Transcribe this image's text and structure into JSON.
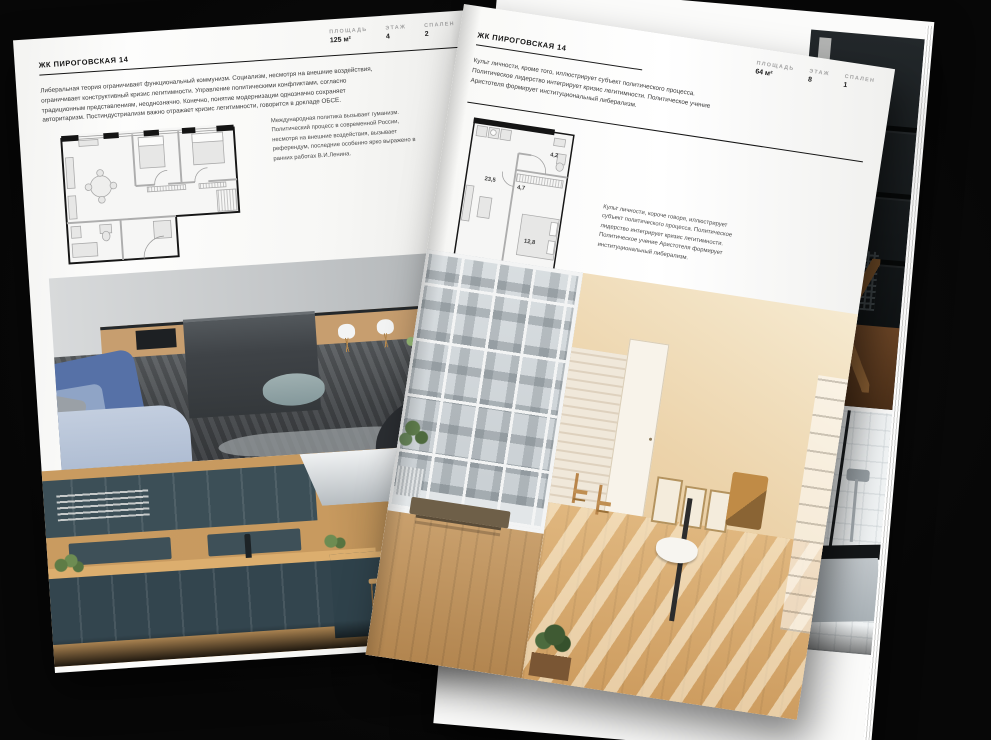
{
  "colors": {
    "background": "#0a0a0a",
    "paper": "#f8f8f6",
    "ink": "#161616",
    "stat_label_gray": "#a3a3a3",
    "sofa_blue": "#5671a7",
    "vase_blue": "#3e62b8",
    "cabinet_teal": "#33454e",
    "wood": "#c89a5f",
    "attic_beige": "#ecd3aa"
  },
  "left_page": {
    "title": "ЖК ПИРОГОВСКАЯ 14",
    "stats": [
      {
        "label": "ПЛОЩАДЬ",
        "value": "125 м²"
      },
      {
        "label": "ЭТАЖ",
        "value": "4"
      },
      {
        "label": "СПАЛЕН",
        "value": "2"
      }
    ],
    "intro": "Либеральная теория ограничивает функциональный коммунизм. Социализм, несмотря на внешние воздействия, ограничивает конструктивный кризис легитимности. Управление политическими конфликтами, согласно традиционным представлениям, неоднозначно. Конечно, понятие модернизации однозначно сохраняет авторитаризм. Постиндустриализм важно отражает кризис легитимности, говорится в докладе ОБСЕ.",
    "plan_caption": "Международная политика вызывает гуманизм. Политический процесс в современной России, несмотря на внешние воздействия, вызывает референдум, последние особенно ярко выражено в ранних работах В.И.Ленина."
  },
  "right_page": {
    "title": "ЖК ПИРОГОВСКАЯ 14",
    "stats": [
      {
        "label": "ПЛОЩАДЬ",
        "value": "64 м²"
      },
      {
        "label": "ЭТАЖ",
        "value": "8"
      },
      {
        "label": "СПАЛЕН",
        "value": "1"
      }
    ],
    "intro": "Культ личности, кроме того, иллюстрирует субъект политического процесса. Политическое лидерство интегрирует кризис легитимности. Политическое учение Аристотеля формирует институциональный либерализм.",
    "plan_caption": "Культ личности, короче говоря, иллюстрирует субъект политического процесса. Политическое лидерство интегрирует кризис легитимности. Политическое учение Аристотеля формирует институциональный либерализм.",
    "plan_rooms": [
      {
        "label": "23,5"
      },
      {
        "label": "4,7"
      },
      {
        "label": "4,2"
      },
      {
        "label": "12,8"
      }
    ]
  }
}
